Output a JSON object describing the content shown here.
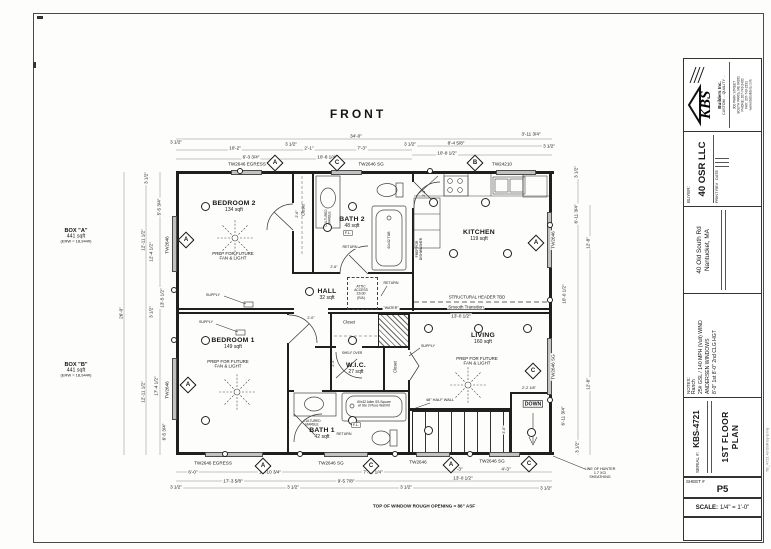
{
  "front_label": "FRONT",
  "box_a": {
    "name": "BOX \"A\"",
    "area": "441 sqft",
    "erw": "(ERW = 18,944#)"
  },
  "box_b": {
    "name": "BOX \"B\"",
    "area": "441 sqft",
    "erw": "(ERW = 18,944#)"
  },
  "rooms": [
    {
      "name": "BEDROOM 2",
      "area": "134 sqft",
      "x": 234,
      "y": 206
    },
    {
      "name": "BEDROOM 1",
      "area": "149 sqft",
      "x": 233,
      "y": 343
    },
    {
      "name": "KITCHEN",
      "area": "119 sqft",
      "x": 479,
      "y": 235
    },
    {
      "name": "LIVING",
      "area": "160 sqft",
      "x": 483,
      "y": 338
    },
    {
      "name": "BATH 2",
      "area": "48 sqft",
      "x": 352,
      "y": 222
    },
    {
      "name": "BATH 1",
      "area": "42 sqft",
      "x": 322,
      "y": 433
    },
    {
      "name": "HALL",
      "area": "32 sqft",
      "x": 327,
      "y": 294
    },
    {
      "name": "W.I.C.",
      "area": "27 sqft",
      "x": 356,
      "y": 368
    }
  ],
  "dims": [
    {
      "t": "34'-0\"",
      "x": 356,
      "y": 136,
      "bg": 1
    },
    {
      "t": "3 1/2\"",
      "x": 176,
      "y": 142,
      "bg": 1
    },
    {
      "t": "3 1/2\"",
      "x": 291,
      "y": 144,
      "bg": 1
    },
    {
      "t": "3 1/2\"",
      "x": 410,
      "y": 144,
      "bg": 1
    },
    {
      "t": "3 1/2\"",
      "x": 549,
      "y": 146,
      "bg": 1
    },
    {
      "t": "10'-2\"",
      "x": 235,
      "y": 148,
      "bg": 1
    },
    {
      "t": "2'-1\"",
      "x": 309,
      "y": 148,
      "bg": 1
    },
    {
      "t": "7'-3\"",
      "x": 362,
      "y": 148,
      "bg": 1
    },
    {
      "t": "6'-3 3/4\"",
      "x": 251,
      "y": 157,
      "bg": 1
    },
    {
      "t": "10'-8 1/4\"",
      "x": 327,
      "y": 157,
      "bg": 1
    },
    {
      "t": "3'-11 3/4\"",
      "x": 531,
      "y": 134,
      "bg": 1
    },
    {
      "t": "8'-4 5/8\"",
      "x": 456,
      "y": 143,
      "bg": 1
    },
    {
      "t": "10'-8 1/2\"",
      "x": 447,
      "y": 153,
      "bg": 1
    },
    {
      "t": "6'-0\"",
      "x": 193,
      "y": 472,
      "bg": 1
    },
    {
      "t": "10'-10 3/4\"",
      "x": 270,
      "y": 472,
      "bg": 1
    },
    {
      "t": "7'-10 1/4\"",
      "x": 373,
      "y": 472,
      "bg": 1
    },
    {
      "t": "7'-3\"",
      "x": 458,
      "y": 469,
      "bg": 1
    },
    {
      "t": "4'-3\"",
      "x": 506,
      "y": 469,
      "bg": 1
    },
    {
      "t": "17'-3 5/8\"",
      "x": 233,
      "y": 481,
      "bg": 1
    },
    {
      "t": "9'-5 7/8\"",
      "x": 346,
      "y": 481,
      "bg": 1
    },
    {
      "t": "13'-0 1/2\"",
      "x": 463,
      "y": 478,
      "bg": 1
    },
    {
      "t": "3 1/2\"",
      "x": 176,
      "y": 487,
      "bg": 1
    },
    {
      "t": "3 1/2\"",
      "x": 293,
      "y": 487,
      "bg": 1
    },
    {
      "t": "3 1/2\"",
      "x": 406,
      "y": 487,
      "bg": 1
    },
    {
      "t": "3 1/2\"",
      "x": 546,
      "y": 488,
      "bg": 1
    },
    {
      "t": "3 1/2\"",
      "x": 146,
      "y": 178,
      "r": 1,
      "bg": 1
    },
    {
      "t": "5'-5 3/4\"",
      "x": 159,
      "y": 207,
      "r": 1,
      "bg": 1
    },
    {
      "t": "12'-4 1/2\"",
      "x": 151,
      "y": 252,
      "r": 1,
      "bg": 1
    },
    {
      "t": "13'-5 1/2\"",
      "x": 162,
      "y": 298,
      "r": 1,
      "bg": 1
    },
    {
      "t": "12'-11 1/2\"",
      "x": 143,
      "y": 240,
      "r": 1,
      "bg": 1
    },
    {
      "t": "26'-0\"",
      "x": 121,
      "y": 313,
      "r": 1,
      "bg": 1
    },
    {
      "t": "12'-11 1/2\"",
      "x": 143,
      "y": 392,
      "r": 1,
      "bg": 1
    },
    {
      "t": "17'-4 1/2\"",
      "x": 156,
      "y": 386,
      "r": 1,
      "bg": 1
    },
    {
      "t": "6'-5 3/4\"",
      "x": 164,
      "y": 432,
      "r": 1,
      "bg": 1
    },
    {
      "t": "3 1/2\"",
      "x": 151,
      "y": 312,
      "r": 1,
      "bg": 1
    },
    {
      "t": "3 1/2\"",
      "x": 576,
      "y": 172,
      "r": 1,
      "bg": 1
    },
    {
      "t": "6'-11 3/4\"",
      "x": 576,
      "y": 214,
      "r": 1,
      "bg": 1
    },
    {
      "t": "12'-8\"",
      "x": 588,
      "y": 243,
      "r": 1,
      "bg": 1
    },
    {
      "t": "10'-0 1/2\"",
      "x": 564,
      "y": 294,
      "r": 1,
      "bg": 1
    },
    {
      "t": "12'-8\"",
      "x": 588,
      "y": 384,
      "r": 1,
      "bg": 1
    },
    {
      "t": "6'-11 3/4\"",
      "x": 563,
      "y": 416,
      "r": 1,
      "bg": 1
    },
    {
      "t": "3 1/2\"",
      "x": 577,
      "y": 447,
      "r": 1,
      "bg": 1
    },
    {
      "t": "13'-0 1/2\"",
      "x": 461,
      "y": 316,
      "bg": 1
    },
    {
      "t": "2'-2 1/8\"",
      "x": 529,
      "y": 388,
      "s": 3.8,
      "bg": 1
    },
    {
      "t": "2'-0\"",
      "x": 311,
      "y": 318,
      "s": 3.6,
      "bg": 1
    },
    {
      "t": "2'-4\"",
      "x": 333,
      "y": 363,
      "s": 3.6,
      "r": 1
    },
    {
      "t": "3'-6\"",
      "x": 504,
      "y": 430,
      "s": 3.6,
      "r": 1,
      "bg": 1
    },
    {
      "t": "2'-8\"",
      "x": 424,
      "y": 193,
      "s": 3.6,
      "r": 1
    },
    {
      "t": "2'-6\"",
      "x": 297,
      "y": 214,
      "s": 3.6,
      "r": 1
    },
    {
      "t": "2'-6\"",
      "x": 334,
      "y": 267,
      "s": 3.6,
      "bg": 1
    }
  ],
  "window_labels": [
    {
      "t": "TW2646 EGRESS",
      "x": 247,
      "y": 164,
      "bg": 1
    },
    {
      "t": "TW2646 SG",
      "x": 371,
      "y": 164,
      "bg": 1
    },
    {
      "t": "TW24210",
      "x": 502,
      "y": 164,
      "bg": 1
    },
    {
      "t": "TW2646 EGRESS",
      "x": 213,
      "y": 463,
      "bg": 1
    },
    {
      "t": "TW2646 SG",
      "x": 331,
      "y": 463,
      "bg": 1
    },
    {
      "t": "TW2646",
      "x": 418,
      "y": 462,
      "bg": 1
    },
    {
      "t": "TW2646 SG",
      "x": 492,
      "y": 461,
      "bg": 1
    },
    {
      "t": "TW2646",
      "x": 167,
      "y": 245,
      "r": 1,
      "bg": 1
    },
    {
      "t": "TW2646",
      "x": 167,
      "y": 390,
      "r": 1,
      "bg": 1
    },
    {
      "t": "TW2646",
      "x": 553,
      "y": 240,
      "r": 1,
      "bg": 1
    },
    {
      "t": "TW2646 SG",
      "x": 553,
      "y": 367,
      "r": 1,
      "bg": 1
    }
  ],
  "window_tags": [
    {
      "l": "A",
      "x": 275,
      "y": 163
    },
    {
      "l": "C",
      "x": 337,
      "y": 163
    },
    {
      "l": "B",
      "x": 475,
      "y": 163
    },
    {
      "l": "A",
      "x": 263,
      "y": 466
    },
    {
      "l": "C",
      "x": 371,
      "y": 466
    },
    {
      "l": "A",
      "x": 451,
      "y": 465
    },
    {
      "l": "C",
      "x": 529,
      "y": 464
    },
    {
      "l": "A",
      "x": 186,
      "y": 240
    },
    {
      "l": "A",
      "x": 188,
      "y": 385
    },
    {
      "l": "A",
      "x": 536,
      "y": 243
    },
    {
      "l": "C",
      "x": 533,
      "y": 371
    }
  ],
  "notes": [
    {
      "t": "PREP FOR FUTURE\nFAN & LIGHT",
      "x": 233,
      "y": 256,
      "s": 4.4
    },
    {
      "t": "PREP FOR FUTURE\nFAN & LIGHT",
      "x": 228,
      "y": 364,
      "s": 4.4
    },
    {
      "t": "PREP FOR FUTURE\nFAN & LIGHT",
      "x": 477,
      "y": 361,
      "s": 4.4
    },
    {
      "t": "STRUCTURAL HEADER TBD",
      "x": 477,
      "y": 297,
      "s": 4.2,
      "bg": 1
    },
    {
      "t": "Smooth Transition",
      "x": 466,
      "y": 307,
      "s": 4.4,
      "bg": 1
    },
    {
      "t": "ATTIC\nACCESS\n22x30\n(R/A)",
      "x": 361,
      "y": 292,
      "s": 3.3,
      "bg": 1
    },
    {
      "t": "SUPPLY",
      "x": 213,
      "y": 295,
      "s": 3.6,
      "bg": 1
    },
    {
      "t": "SUPPLY",
      "x": 206,
      "y": 322,
      "s": 3.6,
      "bg": 1
    },
    {
      "t": "SUPPLY",
      "x": 428,
      "y": 346,
      "s": 3.6,
      "bg": 1
    },
    {
      "t": "RETURN",
      "x": 350,
      "y": 247,
      "s": 3.6,
      "bg": 1
    },
    {
      "t": "RETURN",
      "x": 391,
      "y": 283,
      "s": 3.6,
      "bg": 1
    },
    {
      "t": "RETURN",
      "x": 344,
      "y": 434,
      "s": 3.6,
      "bg": 1
    },
    {
      "t": "\"WATER\"",
      "x": 391,
      "y": 308,
      "s": 3.6,
      "bg": 1
    },
    {
      "t": "48\" HALF WALL",
      "x": 440,
      "y": 400,
      "s": 3.9,
      "bg": 1
    },
    {
      "t": "DOWN",
      "x": 533,
      "y": 404,
      "s": 5.2,
      "b": 1,
      "box": 1
    },
    {
      "t": "LINE OF HUNTER\n1.7 XCI\nSHEATHING",
      "x": 600,
      "y": 473,
      "s": 3.7
    },
    {
      "t": "TOP OF WINDOW ROUGH OPENING = 86\" ASF",
      "x": 424,
      "y": 506,
      "s": 4.6,
      "b": 1
    },
    {
      "t": "PREP FOR\nDISHWASHER",
      "x": 419,
      "y": 249,
      "s": 3.3,
      "r": 1
    },
    {
      "t": "CULTURED\nMARBLE",
      "x": 328,
      "y": 218,
      "s": 3.2,
      "r": 1
    },
    {
      "t": "60x32 TUB",
      "x": 389,
      "y": 240,
      "s": 3.4,
      "r": 1
    },
    {
      "t": "CULTURED\nMARBLE",
      "x": 312,
      "y": 423,
      "s": 3.2
    },
    {
      "t": "60x32 Adler SS-Square\nw/ Ste 3 Piece Wall Kit",
      "x": 374,
      "y": 404,
      "s": 3.2
    },
    {
      "t": "SHELF OVER",
      "x": 352,
      "y": 353,
      "s": 3.2
    },
    {
      "t": "F.L.",
      "x": 348,
      "y": 233,
      "s": 3.8,
      "box": 1
    },
    {
      "t": "F.L.",
      "x": 356,
      "y": 425,
      "s": 3.8,
      "box": 1
    },
    {
      "t": "Closet",
      "x": 303,
      "y": 210,
      "s": 4.2,
      "r": 1
    },
    {
      "t": "Closet",
      "x": 349,
      "y": 322,
      "s": 4.2
    },
    {
      "t": "Closet",
      "x": 395,
      "y": 367,
      "s": 4.2,
      "r": 1
    }
  ],
  "symbols": [
    {
      "x": 205,
      "y": 206
    },
    {
      "x": 352,
      "y": 206
    },
    {
      "x": 205,
      "y": 340
    },
    {
      "x": 352,
      "y": 340
    },
    {
      "x": 205,
      "y": 420
    },
    {
      "x": 352,
      "y": 420
    },
    {
      "x": 433,
      "y": 202
    },
    {
      "x": 485,
      "y": 202
    },
    {
      "x": 453,
      "y": 253
    },
    {
      "x": 507,
      "y": 253
    },
    {
      "x": 428,
      "y": 328
    },
    {
      "x": 478,
      "y": 328
    },
    {
      "x": 527,
      "y": 328
    },
    {
      "x": 428,
      "y": 430
    },
    {
      "x": 531,
      "y": 432
    },
    {
      "x": 309,
      "y": 291
    },
    {
      "x": 327,
      "y": 227
    },
    {
      "x": 240,
      "y": 171,
      "d": 6
    },
    {
      "x": 430,
      "y": 171,
      "d": 6
    },
    {
      "x": 225,
      "y": 454,
      "d": 6
    },
    {
      "x": 300,
      "y": 454,
      "d": 6
    },
    {
      "x": 395,
      "y": 454,
      "d": 6
    },
    {
      "x": 470,
      "y": 454,
      "d": 6
    },
    {
      "x": 550,
      "y": 225,
      "d": 6
    },
    {
      "x": 550,
      "y": 300,
      "d": 6
    },
    {
      "x": 550,
      "y": 400,
      "d": 6
    },
    {
      "x": 174,
      "y": 290,
      "d": 6
    },
    {
      "x": 174,
      "y": 340,
      "d": 6
    }
  ],
  "title_block": {
    "company_name": "KBS",
    "company_tagline": "Builders Inc.",
    "company_motto": "CUSTOM ... QUALITY ...",
    "company_address": [
      "300 PARK STREET",
      "SOUTH PARIS, ME 04281",
      "PHONE: 207-743-2400",
      "FAX: 207-743-2331",
      "www.kbsbuilders.com"
    ],
    "buyer_label": "BUYER:",
    "buyer": "40 OSR LLC",
    "rev_col1": "PRINT REV",
    "rev_col2": "DATE",
    "site_address": [
      "40 Old South Rd",
      "Nantucket, MA"
    ],
    "notes_label": "NOTES:",
    "notes": [
      "Ranch",
      "25# GSL / 140 MPH (Vult) WIND",
      "ANDERSEN WINDOWS",
      "8'-0\" 1st 8'-0\" 2nd CLG HGT"
    ],
    "serial_label": "SERIAL #:",
    "serial": "KBS-4721",
    "drawing_title": "1ST FLOOR PLAN",
    "sheet_label": "SHEET #",
    "sheet": "P5",
    "scale_label": "SCALE:",
    "scale_value": "1/4\" = 1'-0\"",
    "edge_note": "TB_/4721 40 OSR By Emily"
  }
}
